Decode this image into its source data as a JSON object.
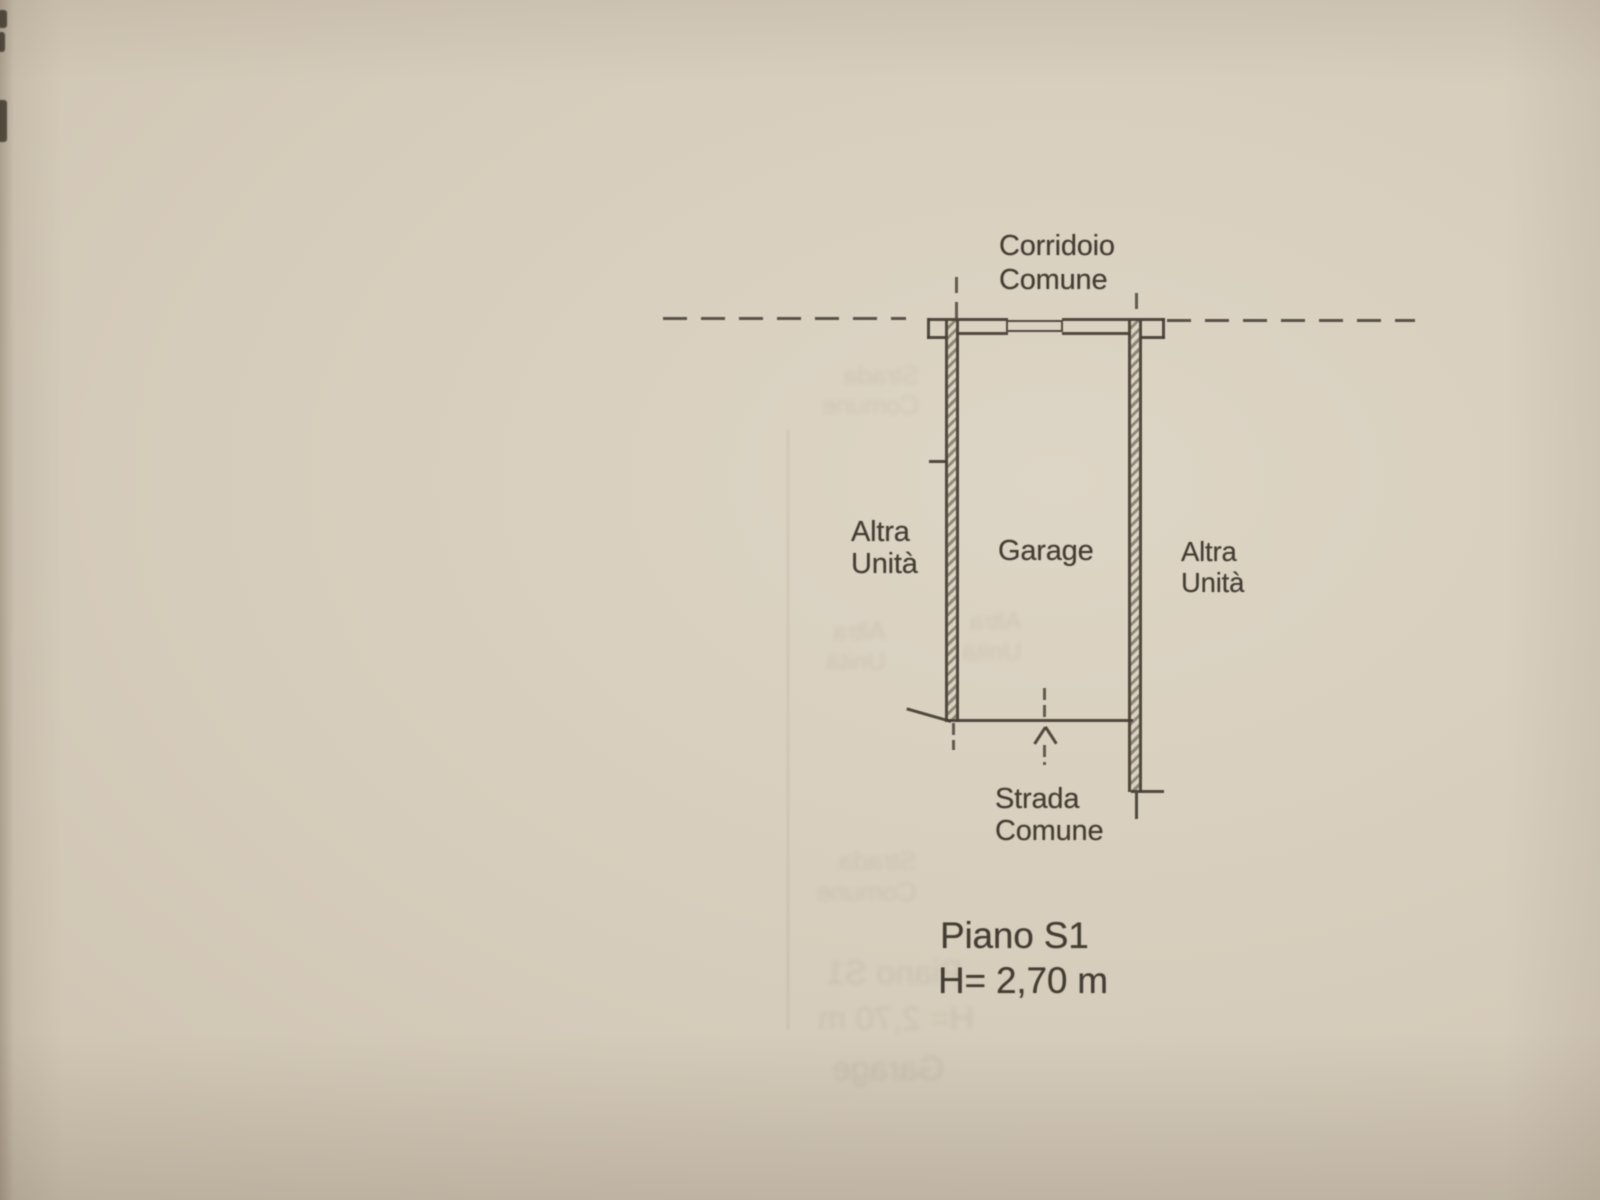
{
  "plan": {
    "labels": {
      "corridor": "Corridoio\nComune",
      "unit_left": "Altra\nUnità",
      "garage": "Garage",
      "unit_right": "Altra\nUnità",
      "street": "Strada\nComune",
      "floor": "Piano S1",
      "ceiling_height": "H= 2,70 m"
    },
    "colors": {
      "paper": "#d6ccbb",
      "ink": "#453e34"
    }
  }
}
